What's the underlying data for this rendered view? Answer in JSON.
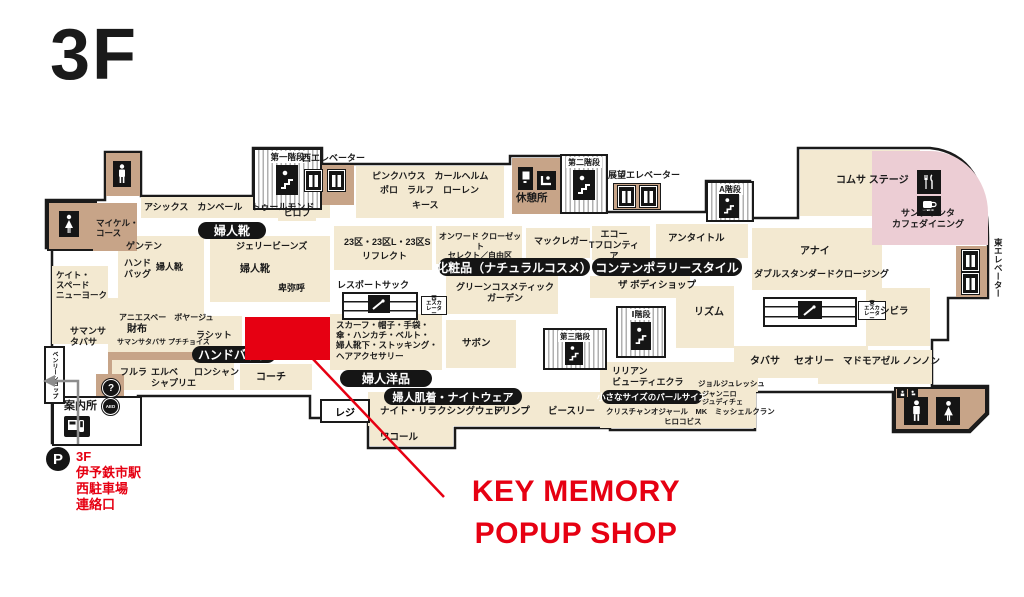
{
  "floor": {
    "title": "3F"
  },
  "annotation": {
    "line1": "KEY MEMORY",
    "line2": "POPUP SHOP"
  },
  "parking": {
    "symbol": "P",
    "line1": "3F",
    "line2": "伊予鉄市駅",
    "line3": "西駐車場",
    "line4": "連絡口"
  },
  "icons": {
    "info": "?",
    "aed": "AED"
  },
  "colors": {
    "accent_red": "#e60012",
    "cream": "#f3e9d1",
    "tan": "#c7a488",
    "pink": "#eccdd4"
  },
  "badges": {
    "women_shoes": "婦人靴",
    "handbags": "ハンドバッグ",
    "women_apparel": "婦人洋品",
    "lingerie_nightwear": "婦人肌着・ナイトウェア",
    "cosmetics": "化粧品（ナチュラルコスメ）",
    "contemporary_style": "コンテンポラリースタイル",
    "pearl_size": "小さなサイズのパールサイズ"
  },
  "labels": {
    "michael_kors": "マイケル・\nコース",
    "asics_row": "アシックス　カンベール　トゥールモンド",
    "hirofu": "ヒロフ",
    "genten": "ゲンテン",
    "handbag_small": "ハンド\nバッグ",
    "women_shoes_small": "婦人靴",
    "kate_spade": "ケイト・\nスペード\nニューヨーク",
    "jelly_beans": "ジェリービーンズ",
    "women_shoes_center": "婦人靴",
    "himiko": "卑弥呼",
    "samantha_thavasa": "サマンサ\nタバサ",
    "agnes_voyage": "アニエスベー　ボヤージュ",
    "wallets": "財布",
    "samantha_petit": "サマンサタバサ プチチョイス",
    "russet": "ラシット",
    "furla": "フルラ",
    "herve_chapelier": "エルベ\nシャプリエ",
    "longchamp": "ロンシャン",
    "coach": "コーチ",
    "information": "案内所",
    "benly_shop": "ベンリーショップ",
    "register": "レジ",
    "stairs_1": "第一階段",
    "west_elevator": "西エレベーター",
    "pink_house": "ピンクハウス　カールヘルム",
    "polo_ralph_lauren": "ポロ　ラルフ　ローレン",
    "keith": "キース",
    "rest_area": "休憩所",
    "stairs_2": "第二階段",
    "observation_elevator": "展望エレベーター",
    "stairs_a": "A階段",
    "comme_ca_stage": "コムサ ステージ",
    "santa_cafe": "サンタサンタ\nカフェダイニング",
    "east_elevator": "東エレベーター",
    "ward23": "23区・23区L・23区S",
    "reflect": "リフレクト",
    "onward": "オンワード クローゼット\nセレクト／自由区",
    "mcgregor": "マックレガー",
    "ecco_t": "エコー\nTフロンティア",
    "untitled": "アンタイトル",
    "anayi": "アナイ",
    "double_standard": "ダブルスタンダードクロージング",
    "lesportsac": "レスポートサック",
    "west_escalator": "西\nエスカレーター",
    "green_cosmetic": "グリーンコスメティック\nガーデン",
    "body_shop": "ザ ボディショップ",
    "rhythm": "リズム",
    "east_escalator": "東\nエスカレーター",
    "accessories": "スカーフ・帽子・手袋・\n傘・ハンカチ・ベルト・\n婦人靴下・ストッキング・\nヘアアクセサリー",
    "sabon": "サボン",
    "stairs_3": "第三階段",
    "stairs_i": "Ⅰ階段",
    "tabatha": "タバサ",
    "theory": "セオリー",
    "mademoiselle_nonnon": "マドモアゼル ノンノン",
    "sybilla": "シビラ",
    "lilian_beaute": "リリアン\nビューティエクラ",
    "georges_rech": "ジョルジュレッシュ",
    "gianni_lo_giudice": "ジャンニロ\nジュディチェ",
    "christian_aujard_row": "クリスチャンオジャール　MK　ミッシェルクラン",
    "hiroko_bis": "ヒロコビス",
    "night_relaxing": "ナイト・リラクシングウェア",
    "triumph": "トリンプ",
    "b_three": "ビースリー",
    "wacoal": "ワコール"
  }
}
